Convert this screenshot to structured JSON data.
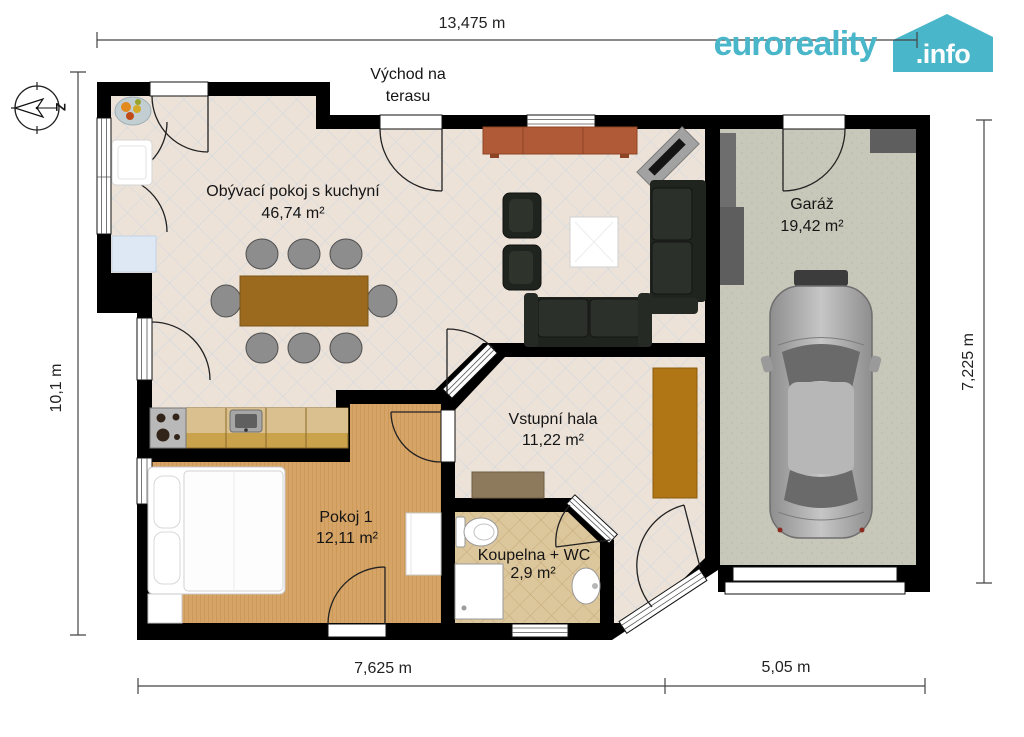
{
  "logo": {
    "brand": "euroreality",
    "domain": ".info",
    "accent": "#4ab6c9"
  },
  "compass": {
    "west_label": "Z"
  },
  "dimensions": {
    "top": "13,475 m",
    "left": "10,1 m",
    "right": "7,225 m",
    "bottom_left": "7,625 m",
    "bottom_right": "5,05 m"
  },
  "annotations": {
    "terrace_line1": "Východ na",
    "terrace_line2": "terasu"
  },
  "rooms": {
    "living": {
      "name": "Obývací pokoj s kuchyní",
      "area": "46,74 m²"
    },
    "garage": {
      "name": "Garáž",
      "area": "19,42 m²"
    },
    "hall": {
      "name": "Vstupní hala",
      "area": "11,22 m²"
    },
    "bedroom": {
      "name": "Pokoj 1",
      "area": "12,11 m²"
    },
    "bathroom": {
      "name": "Koupelna + WC",
      "area": "2,9 m²"
    }
  },
  "colors": {
    "walls": "#000000",
    "living_floor": "#ede2d8",
    "bathroom_floor": "#dcc69c",
    "bedroom_floor": "#d7a468",
    "garage_floor": "#c7c8b9"
  }
}
